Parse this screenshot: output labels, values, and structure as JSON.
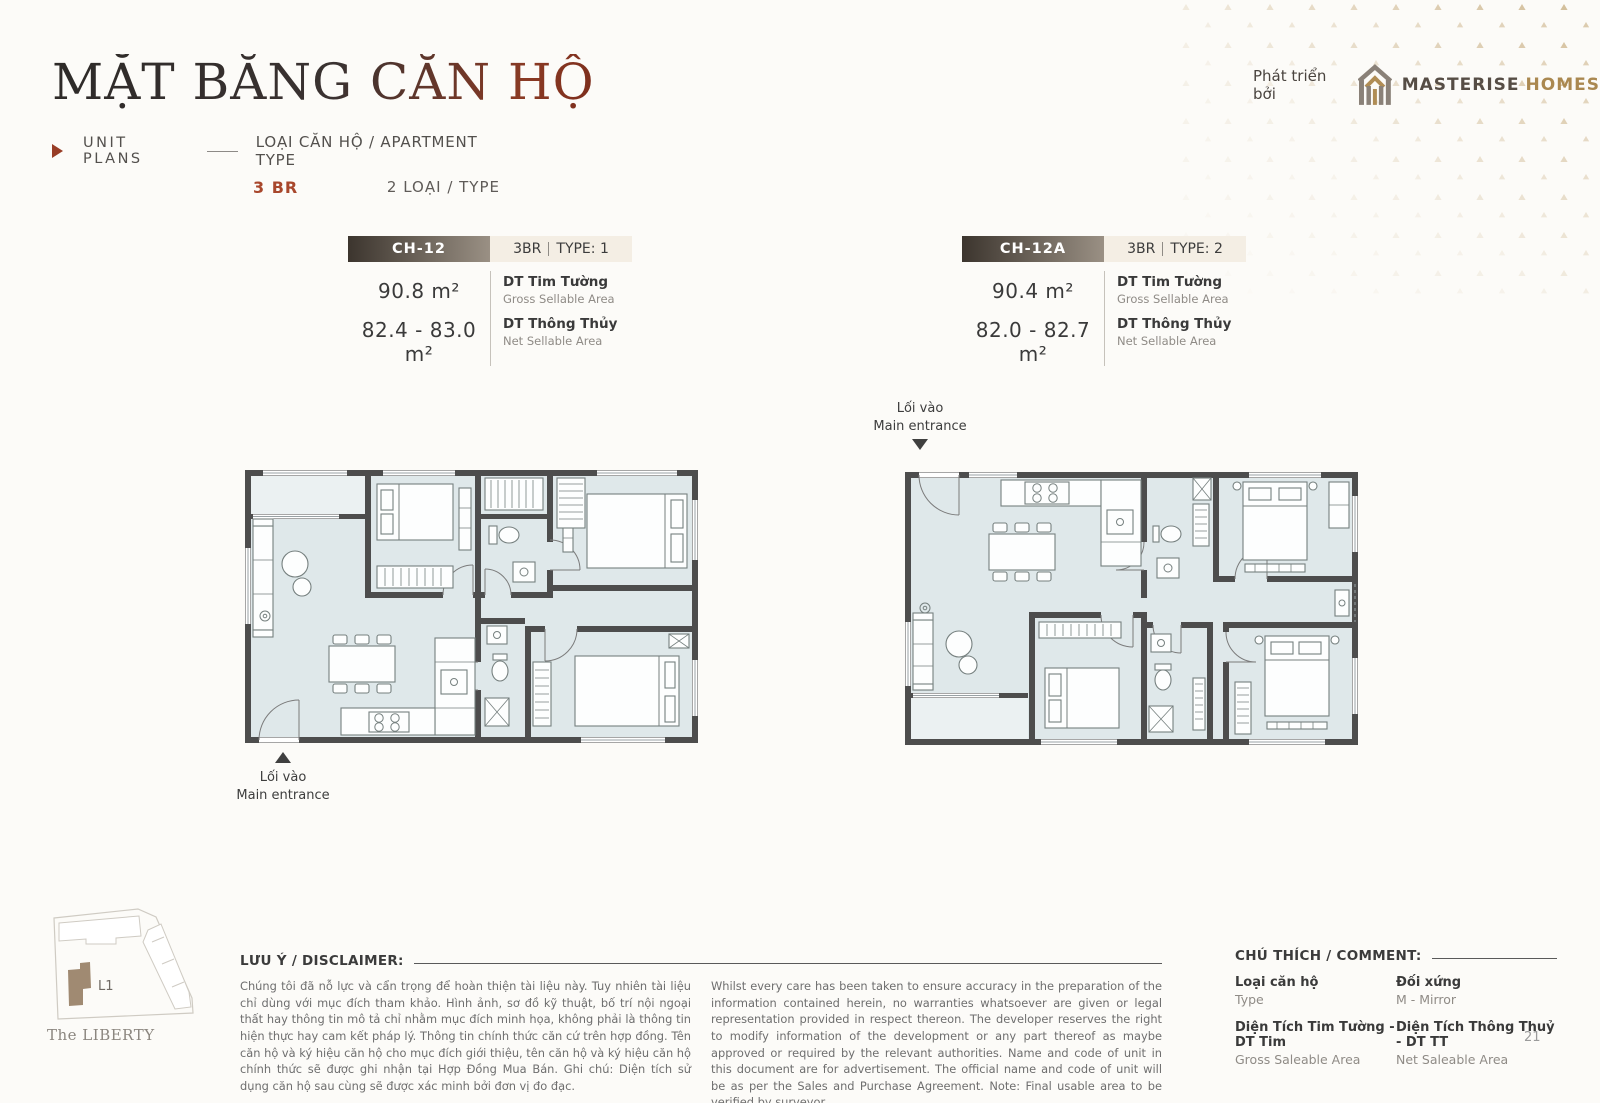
{
  "header": {
    "title": "MẶT BẰNG CĂN HỘ",
    "unit_plans_label": "UNIT PLANS",
    "apartment_type_label": "LOẠI CĂN HỘ / APARTMENT TYPE",
    "bedroom_count": "3 BR",
    "type_count": "2 LOẠI / TYPE",
    "developer_prefix": "Phát triển bởi",
    "developer_name": "MASTERISE",
    "developer_suffix": "HOMES"
  },
  "units": [
    {
      "code": "CH-12",
      "bedrooms": "3BR",
      "type": "TYPE: 1",
      "gross_area": "90.8 m²",
      "net_area": "82.4 - 83.0 m²",
      "gross_label_vi": "DT Tim Tường",
      "gross_label_en": "Gross Sellable Area",
      "net_label_vi": "DT Thông Thủy",
      "net_label_en": "Net Sellable Area",
      "entrance_vi": "Lối vào",
      "entrance_en": "Main entrance"
    },
    {
      "code": "CH-12A",
      "bedrooms": "3BR",
      "type": "TYPE: 2",
      "gross_area": "90.4 m²",
      "net_area": "82.0 - 82.7 m²",
      "gross_label_vi": "DT Tim Tường",
      "gross_label_en": "Gross Sellable Area",
      "net_label_vi": "DT Thông Thủy",
      "net_label_en": "Net Sellable Area",
      "entrance_vi": "Lối vào",
      "entrance_en": "Main entrance"
    }
  ],
  "site_plan": {
    "tower_label": "L1",
    "project_name": "The LIBERTY"
  },
  "disclaimer": {
    "heading": "LƯU Ý / DISCLAIMER:",
    "text_vi": "Chúng tôi đã nỗ lực và cẩn trọng để hoàn thiện tài liệu này. Tuy nhiên tài liệu chỉ dùng với mục đích tham khảo. Hình ảnh, sơ đồ kỹ thuật, bố trí nội ngoại thất hay thông tin mô tả chỉ nhằm mục đích minh họa, không phải là thông tin hiện thực hay cam kết pháp lý. Thông tin chính thức căn cứ trên hợp đồng. Tên căn hộ và ký hiệu căn hộ cho mục đích giới thiệu, tên căn hộ và ký hiệu căn hộ chính thức sẽ được ghi nhận tại Hợp Đồng Mua Bán. Ghi chú: Diện tích sử dụng căn hộ sau cùng sẽ được xác minh bởi đơn vị đo đạc.",
    "text_en": "Whilst every care has been taken to ensure accuracy in the preparation of the information contained herein, no warranties whatsoever are given or legal representation provided in respect thereon. The developer reserves the right to modify information of the development or any part thereof as maybe approved or required by the relevant authorities. Name and code of unit in this document are for advertisement. The official name and code of unit will be as per the Sales and Purchase Agreement. Note: Final usable area to be verified by surveyor."
  },
  "legend": {
    "heading": "CHÚ THÍCH / COMMENT:",
    "items": [
      {
        "vi": "Loại căn hộ",
        "en": "Type"
      },
      {
        "vi": "Đối xứng",
        "en": "M - Mirror"
      },
      {
        "vi": "Diện Tích Tim Tường - DT Tim",
        "en": "Gross Saleable Area"
      },
      {
        "vi": "Diện Tích Thông Thuỷ - DT TT",
        "en": "Net Saleable Area"
      }
    ]
  },
  "footer": {
    "page_number": "21"
  },
  "colors": {
    "accent": "#a8472c",
    "gold": "#b39157",
    "bar_dark": "#3c352e",
    "bar_light": "#9a9084",
    "chip_bg": "#f4eee4",
    "floor_fill": "#dfe8ea",
    "wall": "#4d4d4d"
  }
}
